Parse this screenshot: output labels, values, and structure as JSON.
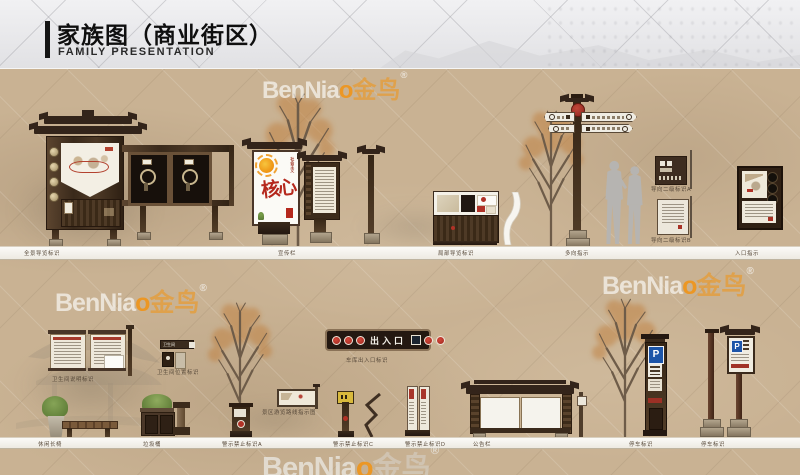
{
  "header": {
    "title": "家族图（商业街区）",
    "subtitle": "FAMILY PRESENTATION"
  },
  "watermark": {
    "latin": "BenNia",
    "o": "o",
    "cjk": "金鸟",
    "reg": "®"
  },
  "signs": {
    "core_values_small": "社会主义",
    "core_values_big": "核心",
    "entrance": "出入口",
    "parking_letter": "P",
    "toilet": "卫生间"
  },
  "labels": {
    "row1": {
      "panoramic": "全景导览标识",
      "bulletin": "宣传栏",
      "local_guide": "局部导览标识",
      "multi_direction": "多向指示",
      "secondary_a": "导向二级标识A",
      "secondary_b": "导向二级标识B",
      "entrance_guide": "入口指示"
    },
    "row2": {
      "toilet_info": "卫生间说明标识",
      "toilet_location": "卫生间位置标识",
      "bench": "休闲长椅",
      "trash": "垃圾桶",
      "garage": "车库出入口标识",
      "route_map": "景区游览路线指示图",
      "warning_a": "警示禁止标识A",
      "warning_c": "警示禁止标识C",
      "warning_d": "警示禁止标识D",
      "notice": "公告栏",
      "parking": "停车标识"
    }
  },
  "colors": {
    "background_tan": "#c9b293",
    "wood": "#46331f",
    "sign_red": "#a93226",
    "parking_blue": "#1d55a8",
    "accent_orange": "#ef9314",
    "header_gray": "#e8e8ea"
  }
}
